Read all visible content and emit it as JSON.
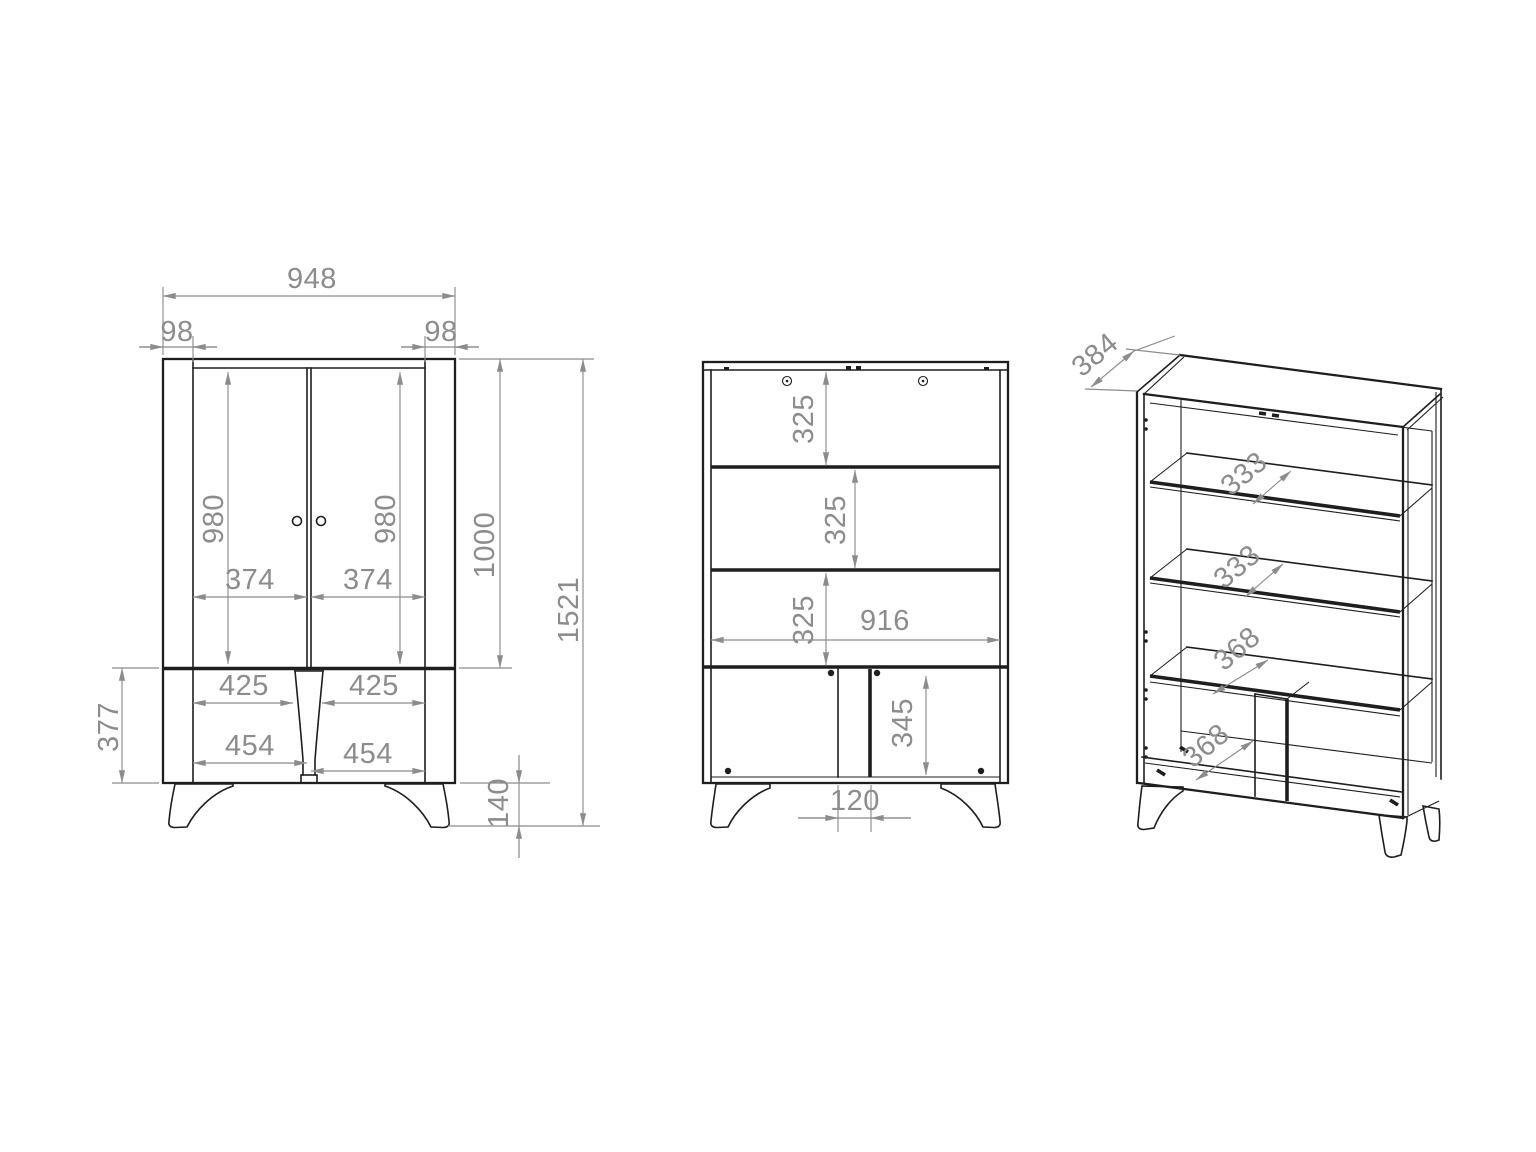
{
  "front": {
    "total_width": "948",
    "left_overhang": "98",
    "right_overhang": "98",
    "left_door_height": "980",
    "right_door_height": "980",
    "left_door_width": "374",
    "right_door_width": "374",
    "upper_section_height": "1000",
    "total_height": "1521",
    "left_drawer_inner_width": "425",
    "right_drawer_inner_width": "425",
    "left_drawer_width": "454",
    "right_drawer_width": "454",
    "lower_section_height": "377",
    "leg_height": "140"
  },
  "internal": {
    "upper_compartment_height": "325",
    "middle_compartment_height": "325",
    "lower_compartment_height": "325",
    "internal_width": "916",
    "bottom_compartment_height": "345",
    "center_partition_width": "120"
  },
  "perspective": {
    "depth": "384",
    "upper_glass_shelf_depth": "333",
    "lower_glass_shelf_depth": "333",
    "middle_shelf_depth": "368",
    "bottom_panel_depth": "368"
  },
  "colors": {
    "line": "#1e1e1e",
    "dim": "#8c8c8c",
    "background": "#ffffff"
  }
}
